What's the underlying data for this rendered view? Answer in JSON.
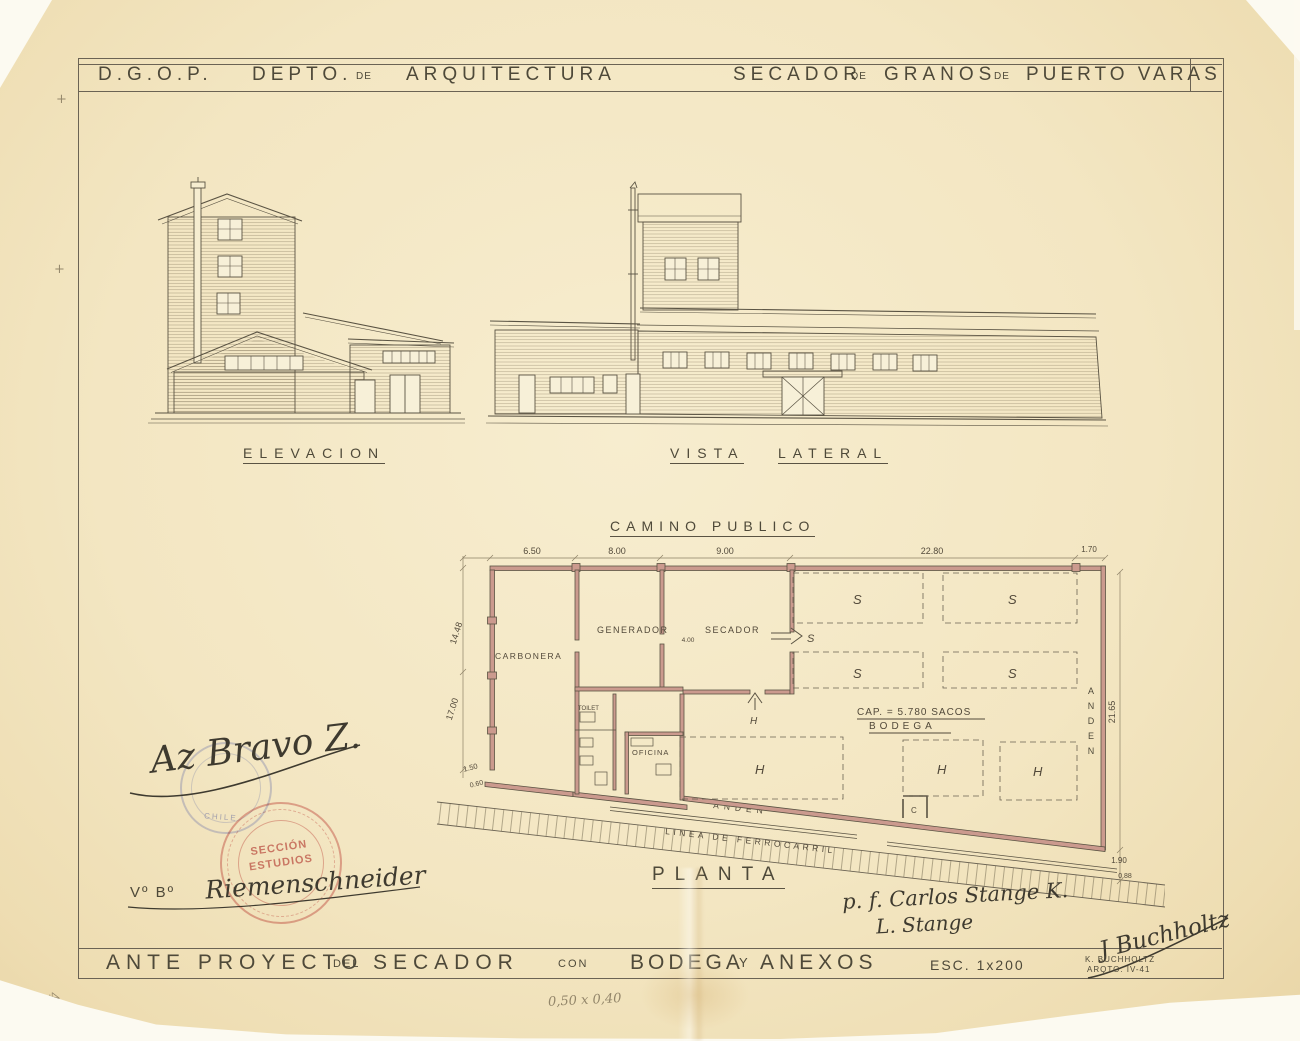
{
  "colors": {
    "paper": "#f3e6c2",
    "ink": "#57503f",
    "pencil": "#8d8166",
    "wall_poche": "#cb9a8e",
    "stamp_red": "#d98585",
    "stamp_blue": "#8f94bf"
  },
  "header": {
    "org": "D.G.O.P.",
    "dept": "DEPTO.",
    "de_small_1": "DE",
    "dept_name": "ARQUITECTURA",
    "proj_1": "SECADOR",
    "de_small_2": "DE",
    "proj_2": "GRANOS",
    "de_small_3": "DE",
    "proj_3": "PUERTO VARAS"
  },
  "drawings": {
    "elevation_label": "ELEVACION",
    "lateral_label_1": "VISTA",
    "lateral_label_2": "LATERAL"
  },
  "plan": {
    "road": "CAMINO PUBLICO",
    "title": "PLANTA",
    "rooms": {
      "carbonera": "CARBONERA",
      "generador": "GENERADOR",
      "secador": "SECADOR",
      "toilet": "TOILET",
      "oficina": "OFICINA",
      "c_room": "C"
    },
    "bodega_cap": "CAP. = 5.780 SACOS",
    "bodega": "BODEGA",
    "s_grid": [
      "S",
      "S",
      "S",
      "S"
    ],
    "s_arrow": "S",
    "h_door": "H",
    "h_areas": [
      "H",
      "H",
      "H"
    ],
    "anden": "ANDEN",
    "anden_right": "ANDEN",
    "railway": "LINEA DE FERROCARRIL",
    "dims": {
      "d1": "6.50",
      "d2": "8.00",
      "d3": "9.00",
      "d4": "22.80",
      "d5": "1.70",
      "left1": "14.48",
      "left2": "17.00",
      "left3": "1.50",
      "left4": "0.60",
      "right1": "21.65",
      "right2": "1.90",
      "right3": "0.88",
      "secador": "4.00"
    }
  },
  "signatures": {
    "approval": "Az Bravo Z.",
    "vobo": "Vº Bº",
    "reviewer": "Riemenschneider",
    "delegate": "p. f. Carlos Stange K.",
    "delegate2": "L. Stange",
    "architect_sig": "J Buchholtz"
  },
  "stamps": {
    "red_1": "SECCIÓN",
    "red_2": "ESTUDIOS",
    "blue": "CHILE"
  },
  "footer": {
    "t1": "ANTE PROYECTO",
    "t2": "DEL",
    "t3": "SECADOR",
    "t4": "CON",
    "t5": "BODEGA",
    "t6": "Y",
    "t7": "ANEXOS",
    "scale": "ESC. 1x200",
    "architect": "K. BUCHHOLTZ",
    "architect_title": "ARQTO. IV-41"
  },
  "notes": {
    "sheet_size": "0,50 x 0,40",
    "file_no": "43940",
    "reg_mark": "+"
  }
}
